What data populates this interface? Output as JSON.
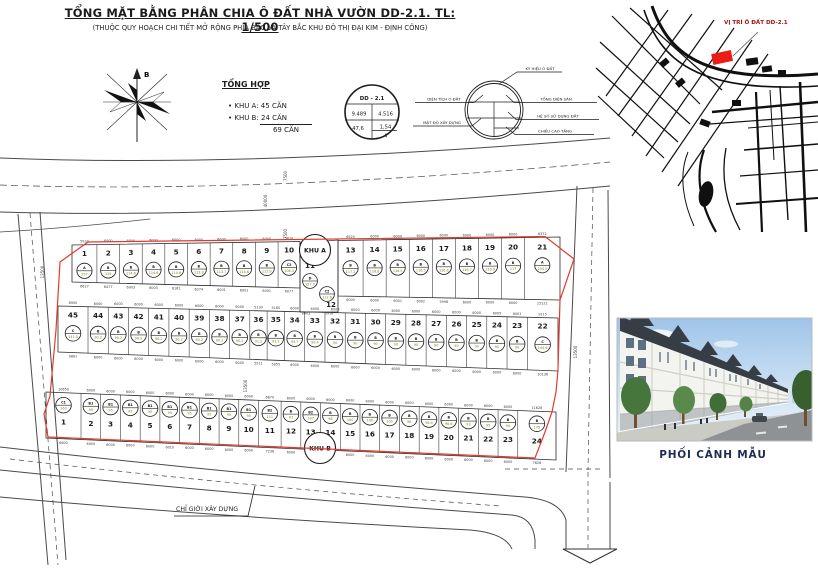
{
  "title": "TỔNG MẶT BẰNG PHÂN CHIA Ô ĐẤT NHÀ VƯỜN DD-2.1. TL: 1/500",
  "subtitle": "(THUỘC QUY HOẠCH CHI TIẾT MỞ RỘNG PHÍA BẮC VÀ TÂY BẮC KHU ĐÔ THỊ ĐẠI KIM - ĐỊNH CÔNG)",
  "compass": {
    "north_label": "B"
  },
  "summary": {
    "heading": "TỔNG HỢP",
    "item_a": "KHU A: 45 CĂN",
    "item_b": "KHU B: 24 CĂN",
    "total": "69 CĂN"
  },
  "plot_symbol": {
    "code": "DD - 2.1",
    "area": "9.489",
    "built_area": "4.516",
    "density": "47,6",
    "far": "1,54",
    "floors": "4",
    "key": {
      "top": "KÝ HIỆU Ô ĐẤT",
      "left1": "DIỆN TÍCH Ô ĐẤT",
      "left2": "MẬT ĐỘ XÂY DỰNG",
      "right1": "TỔNG DIỆN SÀN",
      "right2": "HỆ SỐ SỬ DỤNG ĐẤT",
      "right3": "CHIỀU CAO TẦNG"
    }
  },
  "location_map": {
    "label": "VỊ TRÍ Ô ĐẤT DD-2.1"
  },
  "perspective_caption": "PHỐI CẢNH MẪU",
  "colors": {
    "boundary": "#e23b2e",
    "accent_red": "#ed1c16",
    "map_label": "#a31510",
    "caption": "#1f2d52",
    "area_text": "#8a7a1e"
  },
  "site_plan": {
    "zone_a": "KHU A",
    "zone_b": "KHU B",
    "build_line": "CHỈ GIỚI XÂY DỰNG",
    "road_dims": [
      {
        "t": "7500",
        "x": 287,
        "y": 176
      },
      {
        "t": "40000",
        "x": 267,
        "y": 201
      },
      {
        "t": "7500",
        "x": 287,
        "y": 234
      },
      {
        "t": "13500",
        "x": 44,
        "y": 272
      },
      {
        "t": "13500",
        "x": 247,
        "y": 386
      },
      {
        "t": "13500",
        "x": 577,
        "y": 352
      }
    ],
    "band_a_left": [
      {
        "n": "1",
        "c": "A",
        "a": "257",
        "t": "5933",
        "b": "6627",
        "w": "6600"
      },
      {
        "n": "2",
        "c": "B",
        "a": "129",
        "t": "6000",
        "b": "6477"
      },
      {
        "n": "3",
        "c": "B",
        "a": "114.6",
        "t": "6000",
        "b": "6003"
      },
      {
        "n": "4",
        "c": "B",
        "a": "114.6",
        "t": "6000",
        "b": "6003"
      },
      {
        "n": "5",
        "c": "B",
        "a": "114.6",
        "t": "6000",
        "b": "6162"
      },
      {
        "n": "6",
        "c": "B",
        "a": "113.8",
        "t": "6000",
        "b": "6274"
      },
      {
        "n": "7",
        "c": "B",
        "a": "113.7",
        "t": "6000",
        "b": "6001"
      },
      {
        "n": "8",
        "c": "B",
        "a": "114.6",
        "t": "6000",
        "b": "6001"
      },
      {
        "n": "9",
        "c": "B",
        "a": "115.9",
        "t": "6000",
        "b": "6001"
      },
      {
        "n": "10",
        "c": "C2",
        "a": "106.3",
        "t": "5810",
        "b": "6077"
      }
    ],
    "band_a_mid": [
      {
        "n": "11",
        "c": "D",
        "a": "157.0",
        "b": "8003"
      },
      {
        "n": "12",
        "c": "C2",
        "a": "112.6",
        "b": "5918"
      }
    ],
    "band_a_right": [
      {
        "n": "13",
        "c": "B",
        "a": "117.2",
        "t": "6520",
        "b": "6000"
      },
      {
        "n": "14",
        "c": "B",
        "a": "116.8",
        "t": "6000",
        "b": "6000"
      },
      {
        "n": "15",
        "c": "B",
        "a": "116.5",
        "t": "6000",
        "b": "6001"
      },
      {
        "n": "16",
        "c": "B",
        "a": "116.5",
        "t": "6000",
        "b": "6002"
      },
      {
        "n": "17",
        "c": "B",
        "a": "116.6",
        "t": "6000",
        "b": "5998"
      },
      {
        "n": "18",
        "c": "B",
        "a": "116.7",
        "t": "6000",
        "b": "6000"
      },
      {
        "n": "19",
        "c": "B",
        "a": "116.9",
        "t": "6000",
        "b": "6000"
      },
      {
        "n": "20",
        "c": "B",
        "a": "117",
        "t": "6000",
        "b": "6000"
      },
      {
        "n": "21",
        "c": "A",
        "a": "254.5",
        "t": "6372",
        "b": "15121",
        "w": "9200"
      }
    ],
    "band_m": [
      {
        "n": "45",
        "c": "C",
        "a": "141.5",
        "t": "8900",
        "b": "9861"
      },
      {
        "n": "44",
        "c": "B",
        "a": "90.2",
        "t": "6000",
        "b": "6000"
      },
      {
        "n": "43",
        "c": "B",
        "a": "90.2",
        "t": "6000",
        "b": "6000"
      },
      {
        "n": "42",
        "c": "B",
        "a": "90.2",
        "t": "6000",
        "b": "6000"
      },
      {
        "n": "41",
        "c": "B",
        "a": "90.2",
        "t": "6000",
        "b": "6000"
      },
      {
        "n": "40",
        "c": "B",
        "a": "90.2",
        "t": "6000",
        "b": "6000"
      },
      {
        "n": "39",
        "c": "B",
        "a": "90.2",
        "t": "6000",
        "b": "6000"
      },
      {
        "n": "38",
        "c": "B",
        "a": "90.2",
        "t": "6000",
        "b": "6000"
      },
      {
        "n": "37",
        "c": "B",
        "a": "90.2",
        "t": "6000",
        "b": "6000"
      },
      {
        "n": "36",
        "c": "B",
        "a": "91.2",
        "t": "5130",
        "b": "5911"
      },
      {
        "n": "35",
        "c": "B",
        "a": "93.2",
        "t": "5160",
        "b": "5955"
      },
      {
        "n": "34",
        "c": "B",
        "a": "93.7",
        "t": "6000",
        "b": "6000"
      },
      {
        "n": "33",
        "c": "B",
        "a": "90.4",
        "t": "6000",
        "b": "6000"
      },
      {
        "n": "32",
        "c": "B",
        "a": "90",
        "t": "6000",
        "b": "6000"
      },
      {
        "n": "31",
        "c": "B",
        "a": "90",
        "t": "6000",
        "b": "6000"
      },
      {
        "n": "30",
        "c": "B",
        "a": "90",
        "t": "6000",
        "b": "6000"
      },
      {
        "n": "29",
        "c": "B",
        "a": "90",
        "t": "6000",
        "b": "6000"
      },
      {
        "n": "28",
        "c": "B",
        "a": "90",
        "t": "6000",
        "b": "6000"
      },
      {
        "n": "27",
        "c": "B",
        "a": "90",
        "t": "6000",
        "b": "6000"
      },
      {
        "n": "26",
        "c": "B",
        "a": "90",
        "t": "6000",
        "b": "6000"
      },
      {
        "n": "25",
        "c": "B",
        "a": "90",
        "t": "6000",
        "b": "6000"
      },
      {
        "n": "24",
        "c": "B",
        "a": "90",
        "t": "6005",
        "b": "6000"
      },
      {
        "n": "23",
        "c": "B",
        "a": "90",
        "t": "6001",
        "b": "6000"
      },
      {
        "n": "22",
        "c": "C",
        "a": "144.6",
        "t": "9115",
        "b": "10136"
      }
    ],
    "band_b": [
      {
        "n": "1",
        "c": "C1",
        "a": "160",
        "t": "10650",
        "b": "6600"
      },
      {
        "n": "2",
        "c": "B1",
        "a": "95",
        "t": "6000",
        "b": "6000"
      },
      {
        "n": "3",
        "c": "B1",
        "a": "95",
        "t": "6000",
        "b": "6000"
      },
      {
        "n": "4",
        "c": "B1",
        "a": "95",
        "t": "6000",
        "b": "6000"
      },
      {
        "n": "5",
        "c": "B1",
        "a": "95",
        "t": "6000",
        "b": "6000"
      },
      {
        "n": "6",
        "c": "B1",
        "a": "95",
        "t": "6000",
        "b": "6010"
      },
      {
        "n": "7",
        "c": "B1",
        "a": "95",
        "t": "6000",
        "b": "6000"
      },
      {
        "n": "8",
        "c": "B1",
        "a": "95",
        "t": "6000",
        "b": "6000"
      },
      {
        "n": "9",
        "c": "B1",
        "a": "95",
        "t": "6000",
        "b": "6000"
      },
      {
        "n": "10",
        "c": "B1",
        "a": "95",
        "t": "6000",
        "b": "6000"
      },
      {
        "n": "11",
        "c": "B2",
        "a": "111",
        "t": "6870",
        "b": "7236"
      },
      {
        "n": "12",
        "c": "B",
        "a": "97",
        "t": "6000",
        "b": "6000"
      },
      {
        "n": "13",
        "c": "B2",
        "a": "107",
        "t": "6000",
        "b": "7000"
      },
      {
        "n": "14",
        "c": "B",
        "a": "98",
        "t": "6000",
        "b": "6000"
      },
      {
        "n": "15",
        "c": "B",
        "a": "100",
        "t": "6000",
        "b": "6000"
      },
      {
        "n": "16",
        "c": "B",
        "a": "100",
        "t": "6000",
        "b": "6000"
      },
      {
        "n": "17",
        "c": "B",
        "a": "100",
        "t": "6000",
        "b": "6000"
      },
      {
        "n": "18",
        "c": "B",
        "a": "98",
        "t": "6000",
        "b": "6000"
      },
      {
        "n": "19",
        "c": "B",
        "a": "96.4",
        "t": "6000",
        "b": "6000"
      },
      {
        "n": "20",
        "c": "B",
        "a": "96.6",
        "t": "6000",
        "b": "6000"
      },
      {
        "n": "21",
        "c": "B",
        "a": "93",
        "t": "6000",
        "b": "6000"
      },
      {
        "n": "22",
        "c": "B",
        "a": "95",
        "t": "6000",
        "b": "6000"
      },
      {
        "n": "23",
        "c": "B",
        "a": "94",
        "t": "6000",
        "b": "6000"
      },
      {
        "n": "24",
        "c": "B",
        "a": "175",
        "t": "11628",
        "b": "7628"
      }
    ]
  }
}
